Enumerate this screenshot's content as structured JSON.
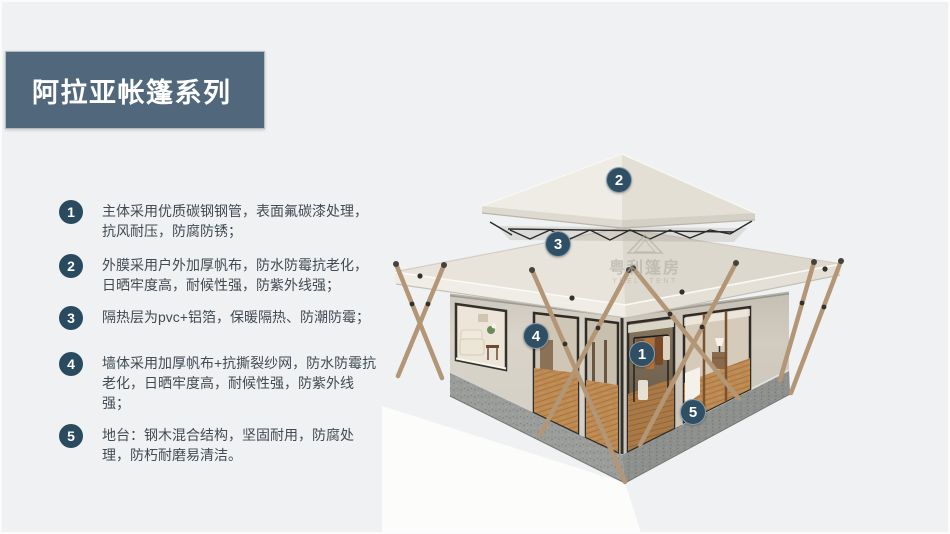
{
  "header": {
    "title": "阿拉亚帐篷系列",
    "bg_color": "#51687c",
    "text_color": "#ffffff"
  },
  "features": [
    {
      "num": "1",
      "text": "主体采用优质碳钢钢管，表面氟碳漆处理，抗风耐压，防腐防锈；"
    },
    {
      "num": "2",
      "text": "外膜采用户外加厚帆布，防水防霉抗老化，日晒牢度高，耐候性强，防紫外线强；"
    },
    {
      "num": "3",
      "text": "隔热层为pvc+铝箔，保暖隔热、防潮防霉；"
    },
    {
      "num": "4",
      "text": "墙体采用加厚帆布+抗撕裂纱网，防水防霉抗老化，日晒牢度高，耐候性强，防紫外线强；"
    },
    {
      "num": "5",
      "text": "地台：钢木混合结构，坚固耐用，防腐处理，防朽耐磨易清洁。"
    }
  ],
  "colors": {
    "badge": "#2a4a5f",
    "callout": "#2f4f64",
    "feature_text": "#414b54",
    "page_background": "#f0f1f2"
  },
  "tent_image": {
    "callouts": [
      {
        "num": "1"
      },
      {
        "num": "2"
      },
      {
        "num": "3"
      },
      {
        "num": "4"
      },
      {
        "num": "5"
      }
    ],
    "watermark": {
      "cn": "粤利篷房",
      "en": "YUELI TENT"
    }
  }
}
